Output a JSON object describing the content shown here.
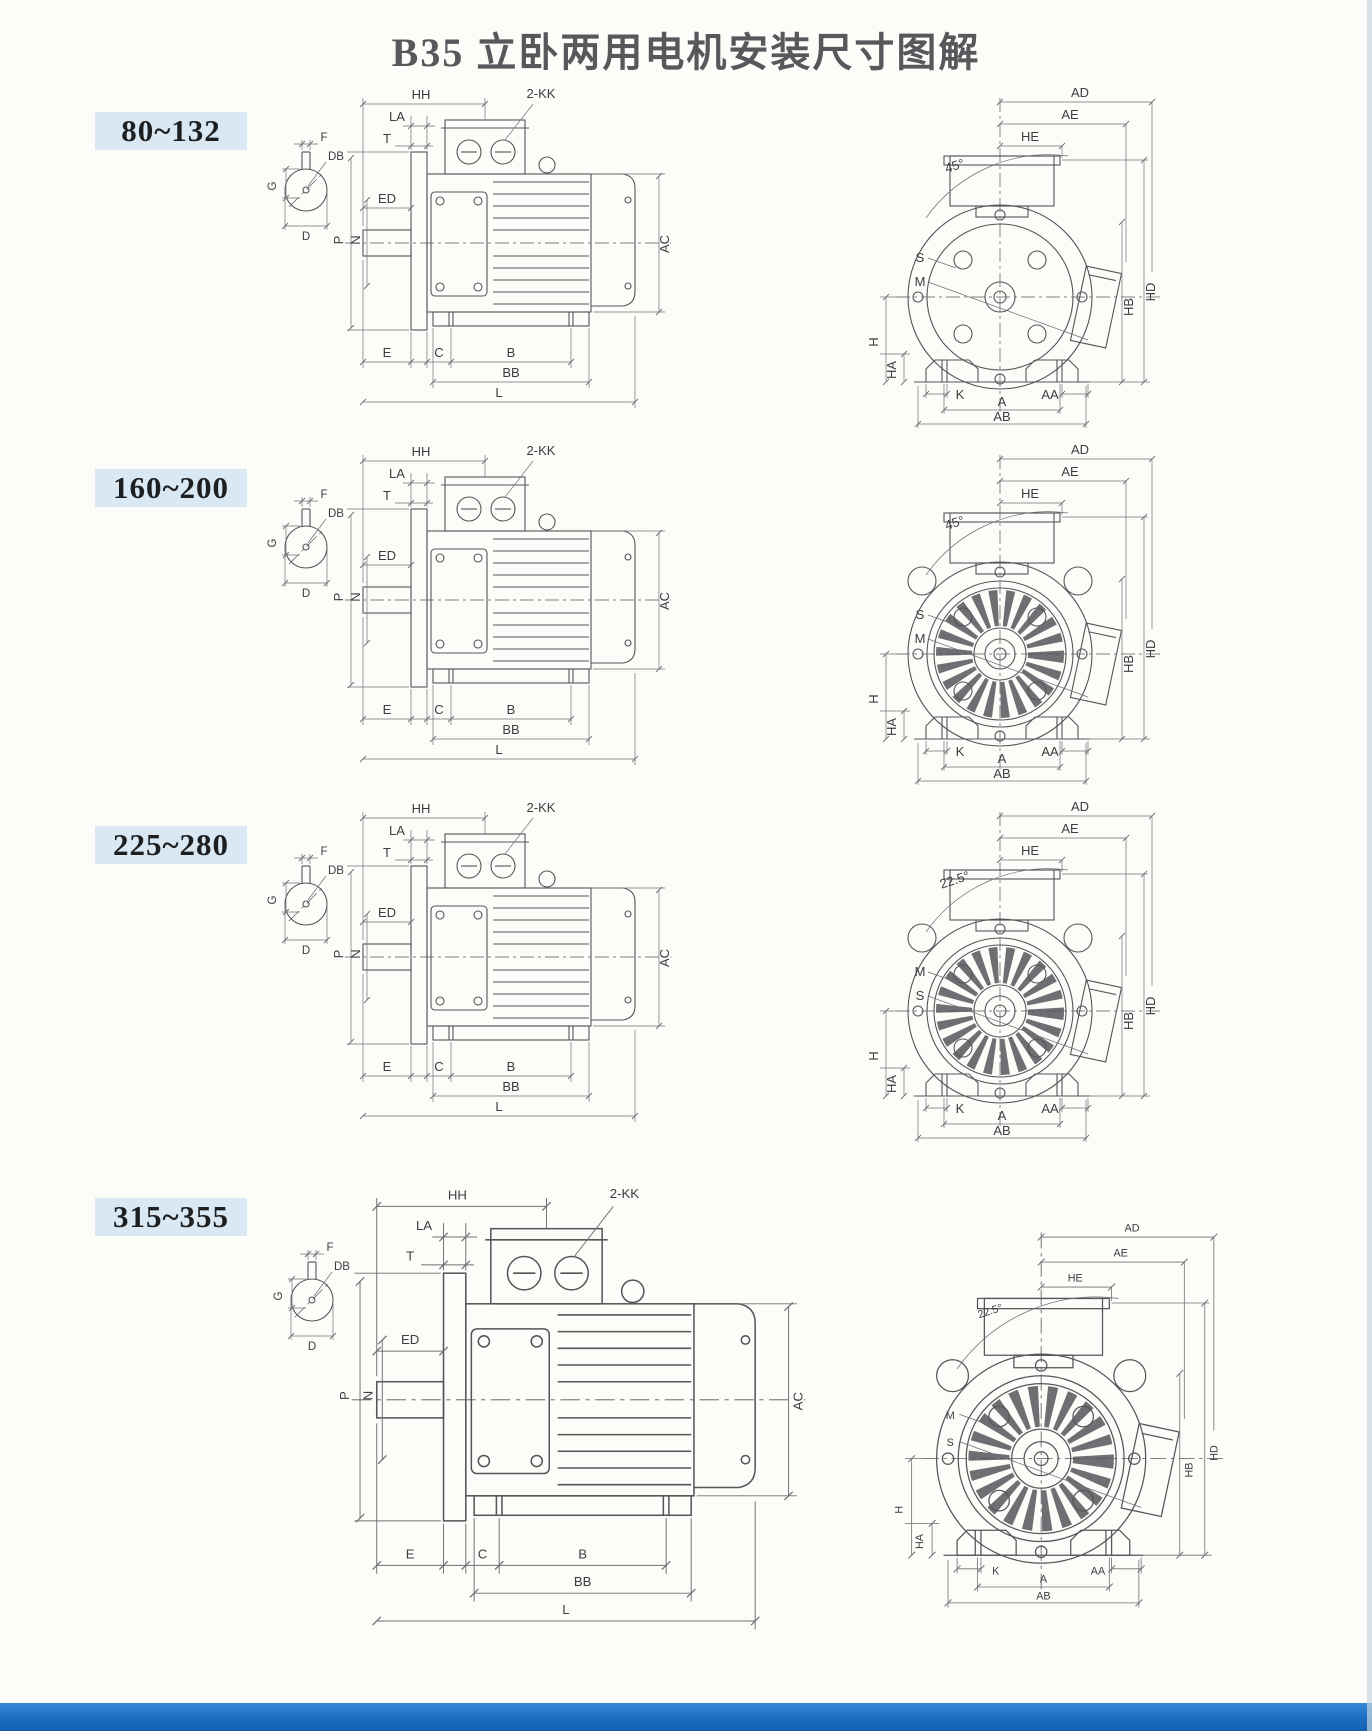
{
  "page": {
    "title": "B35 立卧两用电机安装尺寸图解",
    "colors": {
      "paper": "#fcfcf9",
      "title_text": "#57585c",
      "badge_bg": "#d9e8f2",
      "line": "#55565a",
      "dim_line": "#6f7074",
      "text": "#3c3d40",
      "footer_blue": "#1c6ec2",
      "footer_blue_light": "#3488d8",
      "footer_blue_dark": "#135fae",
      "scan_edge": "#c8d6e0"
    }
  },
  "labels": {
    "shaft": {
      "f": "F",
      "db": "DB",
      "g": "G",
      "d": "D"
    },
    "side": {
      "hh": "HH",
      "kk": "2-KK",
      "la": "LA",
      "t": "T",
      "ed": "ED",
      "p": "P",
      "n": "N",
      "ac": "AC",
      "e": "E",
      "c": "C",
      "b": "B",
      "bb": "BB",
      "l": "L"
    },
    "front": {
      "ad": "AD",
      "ae": "AE",
      "he": "HE",
      "h": "H",
      "ha": "HA",
      "k": "K",
      "aa": "AA",
      "a": "A",
      "ab": "AB",
      "hb": "HB",
      "hd": "HD"
    }
  },
  "sections": [
    {
      "range": "80~132",
      "angle": "45°",
      "upper_label": "S",
      "lower_label": "M",
      "face": "plain"
    },
    {
      "range": "160~200",
      "angle": "45°",
      "upper_label": "S",
      "lower_label": "M",
      "face": "grille"
    },
    {
      "range": "225~280",
      "angle": "22.5°",
      "upper_label": "M",
      "lower_label": "S",
      "face": "grille"
    },
    {
      "range": "315~355",
      "angle": "22.5°",
      "upper_label": "M",
      "lower_label": "S",
      "face": "grille"
    }
  ]
}
